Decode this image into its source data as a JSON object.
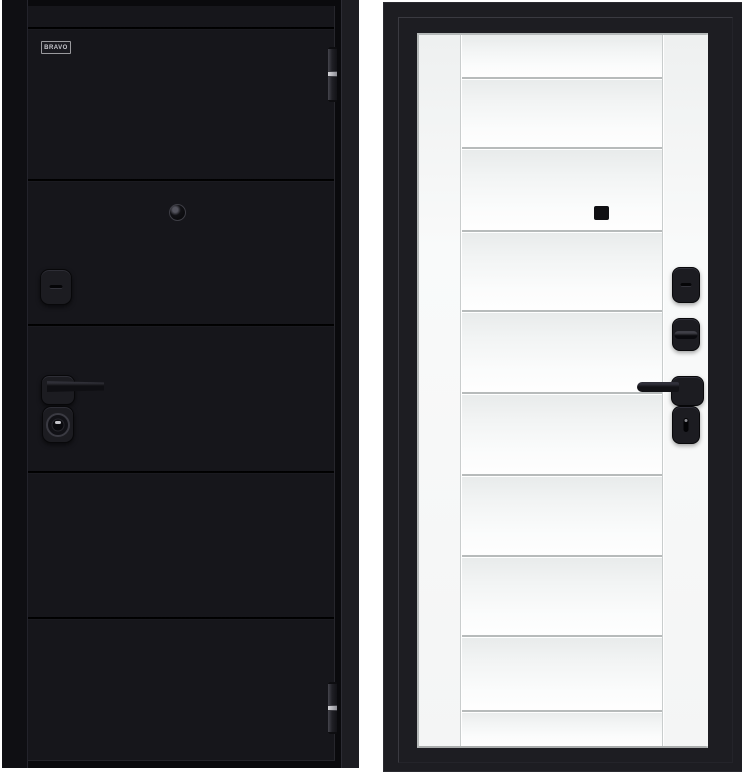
{
  "palette": {
    "page-bg": "#ffffff",
    "door-black": "#16161b",
    "frame-left": "#0f0f13",
    "frame-dark": "#0a0a0d",
    "frame-right": "#1d1d22",
    "leaf-white": "#f5f6f6",
    "hw-black": "#1c1c21",
    "silver": "#97979f",
    "groove-light": "#b7bbbb"
  },
  "left_door": {
    "badge_label": "BRAVO",
    "hardware": [
      "top-hinge",
      "peephole",
      "night-latch-escutcheon",
      "lever-handle",
      "cylinder-lock",
      "bottom-hinge"
    ]
  },
  "right_door": {
    "hardware": [
      "peephole-cover",
      "thumbturn-escutcheon",
      "thumbturn-knob",
      "lever-handle",
      "cylinder-lock"
    ]
  }
}
